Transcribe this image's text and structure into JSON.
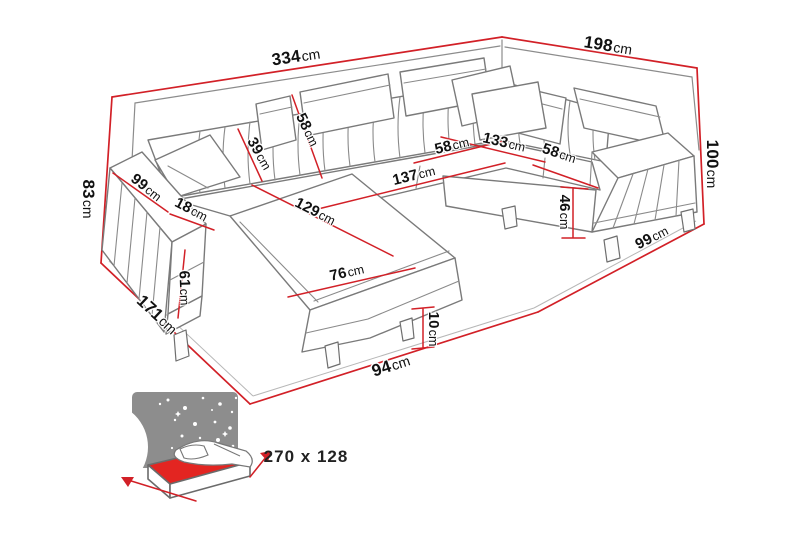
{
  "diagram": {
    "type": "corner-sofa-dimension-drawing",
    "labels": {
      "back_width": {
        "num": "334",
        "unit": "cm"
      },
      "right_width": {
        "num": "198",
        "unit": "cm"
      },
      "left_height": {
        "num": "83",
        "unit": "cm"
      },
      "right_height": {
        "num": "100",
        "unit": "cm"
      },
      "left_depth": {
        "num": "171",
        "unit": "cm"
      },
      "front_width": {
        "num": "94",
        "unit": "cm"
      },
      "right_depth": {
        "num": "99",
        "unit": "cm"
      },
      "backrest_height": {
        "num": "39",
        "unit": "cm"
      },
      "backrest_full_height": {
        "num": "58",
        "unit": "cm"
      },
      "seat_length": {
        "num": "137",
        "unit": "cm"
      },
      "seat_depth": {
        "num": "58",
        "unit": "cm"
      },
      "corner_width": {
        "num": "133",
        "unit": "cm"
      },
      "right_seat_depth": {
        "num": "58",
        "unit": "cm"
      },
      "seat_height": {
        "num": "46",
        "unit": "cm"
      },
      "chaise_length": {
        "num": "129",
        "unit": "cm"
      },
      "chaise_width": {
        "num": "76",
        "unit": "cm"
      },
      "leg_height": {
        "num": "10",
        "unit": "cm"
      },
      "armrest_length": {
        "num": "99",
        "unit": "cm"
      },
      "armrest_width": {
        "num": "18",
        "unit": "cm"
      },
      "armrest_height": {
        "num": "61",
        "unit": "cm"
      }
    },
    "sleeping_area": {
      "label": "270 x 128"
    },
    "colors": {
      "dimension_red": "#d22027",
      "sofa_outline": "#7a7a7a",
      "mattress_red": "#e32521",
      "night_gray": "#8d8d8d"
    }
  }
}
